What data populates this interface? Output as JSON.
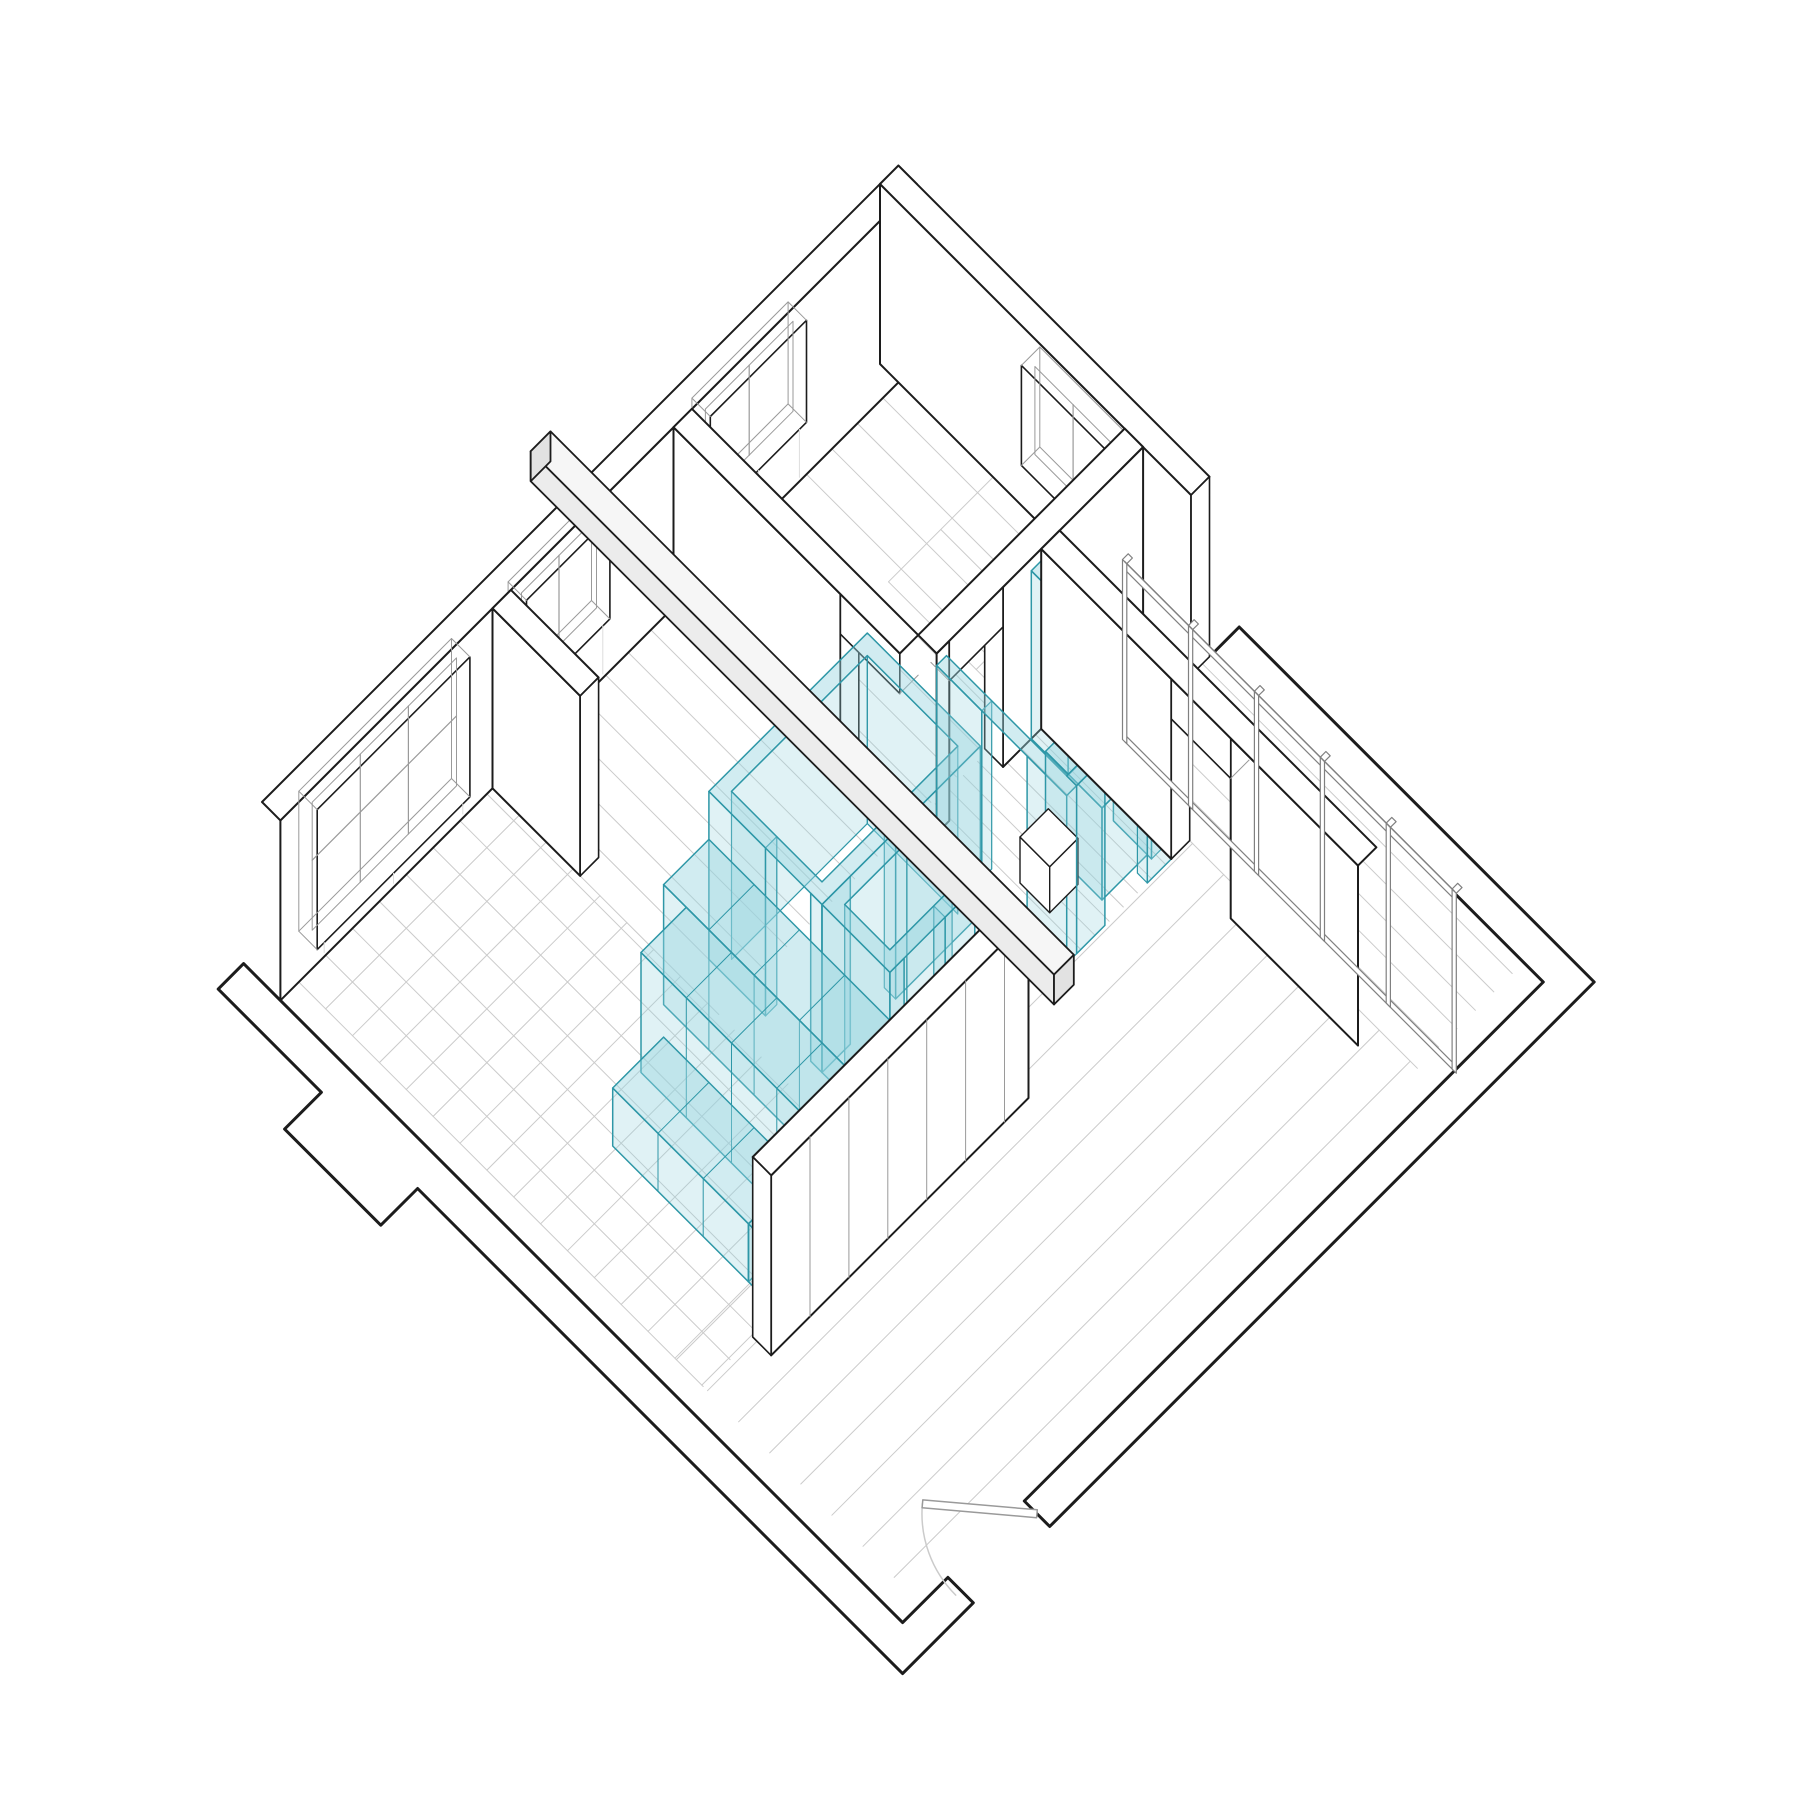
{
  "meta": {
    "title": "Axonometric cutaway floor plan with highlighted service core",
    "drawing_type": "plan-oblique 45 degree architectural axonometric, no text labels"
  },
  "palette": {
    "paper": "#ffffff",
    "ink": "#1c1c1c",
    "thin": "#9a9a9a",
    "faint": "#cbcbcb",
    "fainter": "#dddddd",
    "wall_fill": "#ffffff",
    "beam_top": "#f6f6f6",
    "beam_side": "#ececec",
    "beam_end": "#e2e2e2",
    "cyan_fill": "rgba(151,212,222,0.30)",
    "cyan_top": "rgba(151,212,222,0.44)",
    "cyan_stroke": "#2e97a7",
    "glass_stroke": "#808080"
  },
  "projection": {
    "x0": 262,
    "y0": 982,
    "k": 0.70710678,
    "wall_height": 180,
    "wall_thickness": 26
  },
  "scene": {
    "layers": [
      {
        "name": "floor-west-tiles",
        "type": "tiles",
        "a": [
          26,
          300
        ],
        "b": [
          26,
          598
        ],
        "step": [
          38,
          38
        ]
      },
      {
        "name": "floor-hall-planks",
        "type": "planks",
        "a": [
          300,
          556
        ],
        "b": [
          26,
          346
        ],
        "dir": "b",
        "step": 32
      },
      {
        "name": "floor-north-planks",
        "type": "planks",
        "a": [
          564,
          874
        ],
        "b": [
          26,
          346
        ],
        "dir": "b",
        "step": 36
      },
      {
        "name": "floor-bath-planks",
        "type": "planks",
        "a": [
          582,
          756
        ],
        "b": [
          350,
          556
        ],
        "dir": "b",
        "step": 20
      },
      {
        "name": "floor-nook-planks",
        "type": "planks",
        "a": [
          756,
          786
        ],
        "b": [
          372,
          878
        ],
        "dir": "b",
        "step": 26
      },
      {
        "name": "floor-living-planks",
        "type": "planks",
        "a": [
          26,
          756
        ],
        "b": [
          560,
          878
        ],
        "dir": "a",
        "step": 44
      },
      {
        "name": "floor-terrace-planks",
        "type": "planks",
        "a": [
          786,
          906
        ],
        "b": [
          440,
          878
        ],
        "dir": "b",
        "step": 26
      },
      {
        "name": "bedroom-furniture-strip",
        "type": "tiles",
        "a": [
          726,
          874
        ],
        "b": [
          160,
          346
        ],
        "step": [
          74,
          62
        ]
      },
      {
        "name": "cut-wall-band-southwest",
        "type": "band",
        "pts": [
          [
            0,
            26
          ],
          [
            0,
            906
          ],
          [
            64,
            906
          ],
          [
            64,
            942
          ],
          [
            -36,
            942
          ],
          [
            -36,
            256
          ],
          [
            -88,
            256
          ],
          [
            -88,
            120
          ],
          [
            -36,
            120
          ],
          [
            -36,
            -26
          ],
          [
            0,
            -26
          ]
        ]
      },
      {
        "name": "cut-wall-band-southeast",
        "type": "band",
        "pts": [
          [
            172,
            906
          ],
          [
            906,
            906
          ],
          [
            906,
            440
          ],
          [
            942,
            440
          ],
          [
            942,
            942
          ],
          [
            172,
            942
          ]
        ]
      },
      {
        "name": "entry-door-swing",
        "type": "door",
        "hinge": [
          172,
          924
        ],
        "jamb": [
          57,
          924
        ],
        "leaf_end": [
          98,
          836
        ],
        "radius": 115
      },
      {
        "name": "wall-northwest",
        "type": "wallA",
        "b": [
          0,
          26
        ],
        "a": [
          0,
          900
        ],
        "windows": [
          {
            "a": [
              52,
              268
            ],
            "sill": 14,
            "head": 154,
            "mullions": 2,
            "transom": 90
          },
          {
            "a": [
              348,
              466
            ],
            "sill": 52,
            "head": 154,
            "mullions": 1
          },
          {
            "a": [
              608,
              744
            ],
            "sill": 52,
            "head": 154,
            "mullions": 1
          }
        ]
      },
      {
        "name": "wall-northeast",
        "type": "wallB",
        "a": [
          874,
          900
        ],
        "b": [
          0,
          440
        ],
        "endface": true,
        "windows": [
          {
            "b": [
              200,
              320
            ],
            "sill": 40,
            "head": 140,
            "mullions": 1
          }
        ]
      },
      {
        "name": "partition-hall-bedroom",
        "type": "wallB",
        "a": [
          556,
          582
        ],
        "b": [
          26,
          346
        ],
        "gaps": [
          {
            "span": [
              262,
              346
            ],
            "lintel": true
          }
        ]
      },
      {
        "name": "partition-bedroom-bath",
        "type": "wallA",
        "b": [
          346,
          372
        ],
        "a": [
          582,
          874
        ],
        "gaps": [
          {
            "span": [
              600,
              676
            ],
            "lintel": true
          }
        ]
      },
      {
        "name": "partition-west-stub",
        "type": "wallB",
        "a": [
          300,
          326
        ],
        "b": [
          26,
          150
        ],
        "endface": true
      },
      {
        "name": "core-pod-wall-ne",
        "type": "cwallB",
        "a": [
          716,
          730
        ],
        "b": [
          372,
          542
        ],
        "h": 168,
        "gaps": [
          [
            424,
            488
          ]
        ]
      },
      {
        "name": "core-room-north",
        "type": "ring",
        "a": [
          332,
          556
        ],
        "b": [
          300,
          460
        ],
        "t": 16,
        "h": 168,
        "gap_sw": [
          380,
          444
        ],
        "gap_se": [
          372,
          436
        ]
      },
      {
        "name": "core-pod-wall-w",
        "type": "cwallB",
        "a": [
          582,
          596
        ],
        "b": [
          372,
          556
        ],
        "h": 168,
        "gaps": [
          [
            436,
            500
          ]
        ]
      },
      {
        "name": "core-shower-box",
        "type": "prism",
        "a": [
          652,
          716
        ],
        "b": [
          456,
          536
        ],
        "h": 92,
        "cyan": true
      },
      {
        "name": "core-small-white-box",
        "type": "prism",
        "a": [
          606,
          646
        ],
        "b": [
          466,
          508
        ],
        "h": 46,
        "cyan": false
      },
      {
        "name": "core-pod-wall-s",
        "type": "cwallA",
        "b": [
          542,
          556
        ],
        "a": [
          596,
          730
        ],
        "h": 168,
        "gaps": [
          [
            636,
            696
          ]
        ]
      },
      {
        "name": "partition-east",
        "type": "wallB",
        "a": [
          730,
          756
        ],
        "b": [
          372,
          820
        ],
        "gaps": [
          {
            "span": [
              556,
              640
            ],
            "lintel": true
          }
        ]
      },
      {
        "name": "core-room-south",
        "type": "ring",
        "a": [
          332,
          452
        ],
        "b": [
          460,
          556
        ],
        "t": 16,
        "h": 168,
        "gap_se": [
          352,
          410
        ]
      },
      {
        "name": "core-cabinet-row-1",
        "type": "prism",
        "a": [
          268,
          332
        ],
        "b": [
          300,
          556
        ],
        "h": 120,
        "cyan": true,
        "seam_step": 64
      },
      {
        "name": "core-cabinet-row-2",
        "type": "prism",
        "a": [
          204,
          268
        ],
        "b": [
          332,
          556
        ],
        "h": 120,
        "cyan": true,
        "seam_step": 64
      },
      {
        "name": "core-cabinet-row-3",
        "type": "prism",
        "a": [
          132,
          204
        ],
        "b": [
          364,
          556
        ],
        "h": 58,
        "cyan": true,
        "seam_step": 64
      },
      {
        "name": "core-cabinet-front",
        "type": "prism",
        "a": [
          132,
          268
        ],
        "b": [
          556,
          598
        ],
        "h": 58,
        "cyan": true,
        "seam_step": 68
      },
      {
        "name": "wardrobe-panel-wall",
        "type": "wallA",
        "b": [
          598,
          624
        ],
        "a": [
          96,
          460
        ],
        "seam_step": 55,
        "endface_a": true
      },
      {
        "name": "glass-partition",
        "type": "glass",
        "a": 780,
        "b": [
          440,
          906
        ],
        "h": 180,
        "stiles": 6
      },
      {
        "name": "roof-beam",
        "type": "beam",
        "a": [
          414,
          442
        ],
        "b": [
          -34,
          706
        ],
        "h": [
          184,
          214
        ]
      }
    ]
  }
}
